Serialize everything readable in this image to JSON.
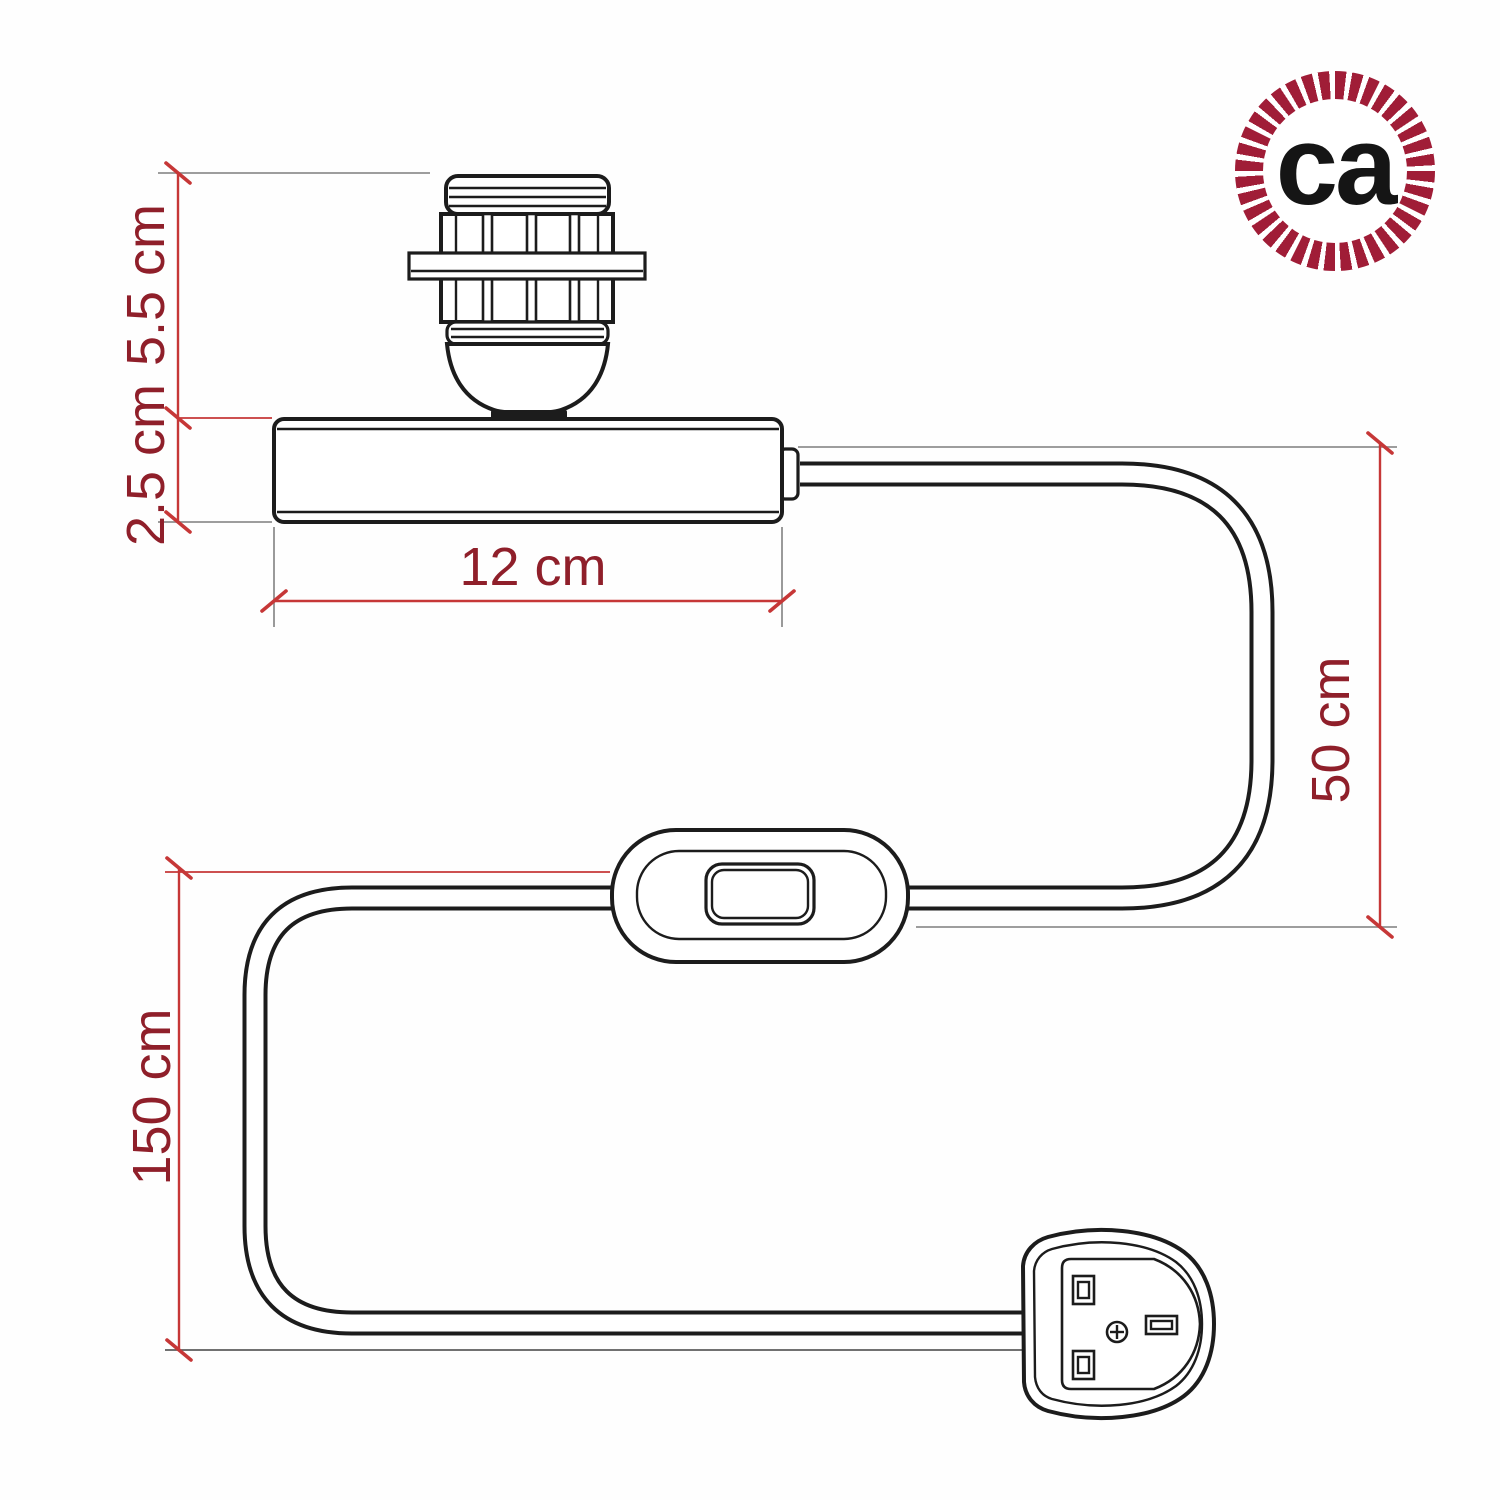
{
  "logo": {
    "text": "ca"
  },
  "dimensions": {
    "socket_height": "5.5 cm",
    "base_height": "2.5 cm",
    "base_width": "12 cm",
    "upper_cable": "50 cm",
    "lower_cable": "150 cm"
  },
  "colors": {
    "bg": "#fefefe",
    "line": "#1c1c1c",
    "dimline": "#c63737",
    "dimtext": "#8f1f2a",
    "extline": "#8f8f8f",
    "logoring": "#a01d37",
    "logotext": "#151515"
  }
}
